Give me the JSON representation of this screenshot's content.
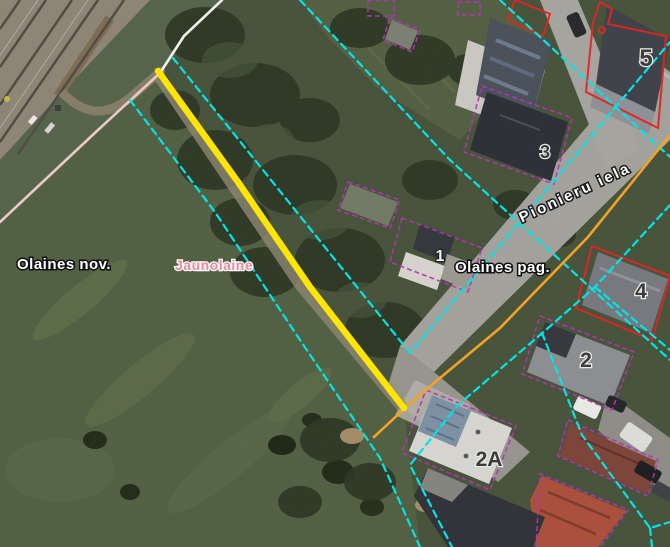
{
  "map": {
    "municipality_labels": [
      {
        "id": "olaines-nov",
        "text": "Olaines nov."
      },
      {
        "id": "jaunolaine",
        "text": "Jaunolaine"
      },
      {
        "id": "olaines-pag",
        "text": "Olaines pag."
      }
    ],
    "street_label": {
      "text": "Pionieru iela"
    },
    "house_numbers": [
      {
        "text": "5"
      },
      {
        "text": "3"
      },
      {
        "text": "1"
      },
      {
        "text": "4"
      },
      {
        "text": "2"
      },
      {
        "text": "2A"
      }
    ],
    "colors": {
      "selected_feature_yellow": "#ffe600",
      "cadastral_cyan": "#00e6e6",
      "road_axis_orange": "#f2a227",
      "boundary_white": "#f2f0ee",
      "boundary_pink": "#eac9c6",
      "building_outline_magenta": "#b435b4",
      "building_outline_red": "#e02525",
      "municipality_label_white": "#ffffff",
      "village_label_pink": "#e8899f",
      "house_number_dark": "#3a3c3f",
      "house_number_light": "#f5f5f2"
    }
  }
}
